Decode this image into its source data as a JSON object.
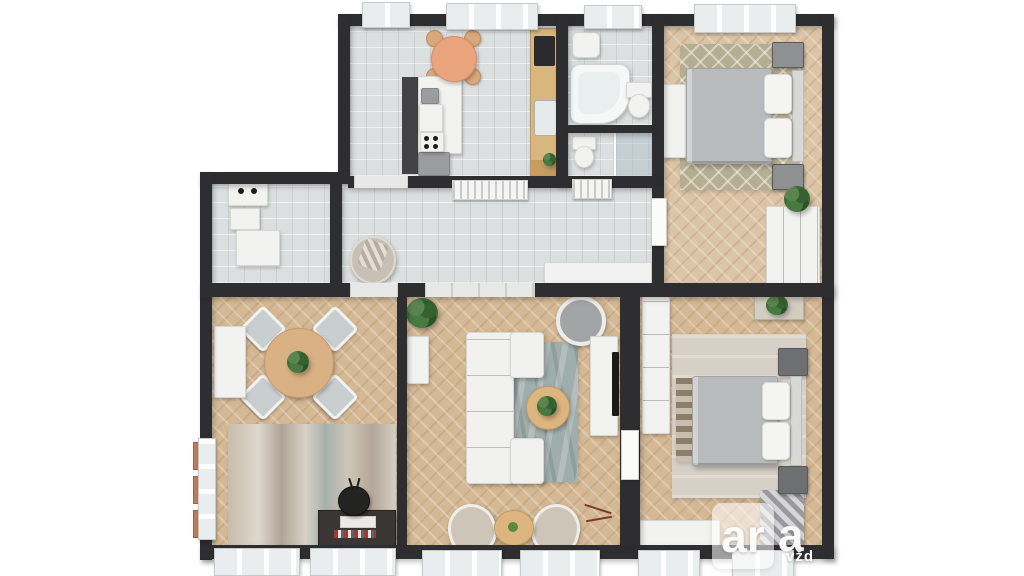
{
  "image": {
    "type": "3d-floor-plan-rendering",
    "description": "Top-down 3D render of a furnished apartment: kitchen, bathroom, shower WC, two bedrooms, hallway, dining room and living room"
  },
  "watermark": {
    "logo_box_text": "ar",
    "logo_suffix_text": "a",
    "tagline_text": "vžd",
    "color": "#ffffff"
  },
  "palette": {
    "background": "#ffffff",
    "wall": "#2e2e30",
    "tile_floor": "#dcdfe0",
    "wood_floor": "#d5b995",
    "wood_floor_light": "#dcc4a6",
    "white_furniture": "#f2f2f0",
    "duvet_gray": "#b9babc",
    "rug_diamond_beige": "#b5ae92",
    "rug_blue_gray": "#9fadab",
    "rug_abstract_beige": "#ccc1b2",
    "table_wood": "#d8b67f",
    "breakfast_table_orange": "#eba57e",
    "dark_cabinet": "#3a3633",
    "plant_green": "#3c6a36",
    "terracotta_shutter": "#b97e5f"
  },
  "rooms": [
    {
      "id": "kitchen",
      "name": "kitchen",
      "floor": "gray tile",
      "items": [
        "round breakfast table",
        "four wooden chairs",
        "white island counter with coffee machine and hob knobs",
        "wooden counter with dark cooktop and sink",
        "cutting board",
        "small plant",
        "windows"
      ]
    },
    {
      "id": "bathroom",
      "name": "bathroom",
      "floor": "gray tile",
      "items": [
        "washbasin",
        "corner bathtub",
        "toilet",
        "window"
      ]
    },
    {
      "id": "shower-wc",
      "name": "shower WC",
      "floor": "gray tile",
      "items": [
        "toilet",
        "glass shower enclosure"
      ]
    },
    {
      "id": "bedroom-top",
      "name": "bedroom 1",
      "floor": "herringbone wood",
      "items": [
        "double bed with gray duvet",
        "two nightstands",
        "diamond-pattern rug",
        "white dresser",
        "white wardrobe",
        "plant",
        "open door",
        "windows"
      ]
    },
    {
      "id": "utility",
      "name": "entry utility room",
      "floor": "gray tile",
      "items": [
        "sink unit with two taps",
        "shelf",
        "cabinet"
      ]
    },
    {
      "id": "hallway",
      "name": "hallway",
      "floor": "gray tile",
      "items": [
        "wicker lounge chair with blanket",
        "white sideboard",
        "two radiators"
      ]
    },
    {
      "id": "dining-room",
      "name": "dining room",
      "floor": "herringbone wood",
      "items": [
        "round dining table with plant centerpiece",
        "four chairs",
        "white side cabinet",
        "abstract rug",
        "dark media cabinet with books",
        "black pot with twigs",
        "terracotta window shutters",
        "windows"
      ]
    },
    {
      "id": "living-room",
      "name": "living room",
      "floor": "herringbone wood",
      "items": [
        "U-shaped white sofa",
        "blue-gray rug",
        "round coffee table with plant",
        "round lounge chair",
        "two beige armchairs",
        "small round table",
        "white TV sideboard",
        "wall TV",
        "plant",
        "open door",
        "windows"
      ]
    },
    {
      "id": "bedroom-bottom",
      "name": "bedroom 2",
      "floor": "herringbone wood",
      "items": [
        "double bed with gray duvet",
        "two dark nightstands",
        "large rug",
        "striped runner",
        "white wardrobe",
        "dresser with plant",
        "white bench",
        "striped chaise",
        "windows"
      ]
    }
  ]
}
